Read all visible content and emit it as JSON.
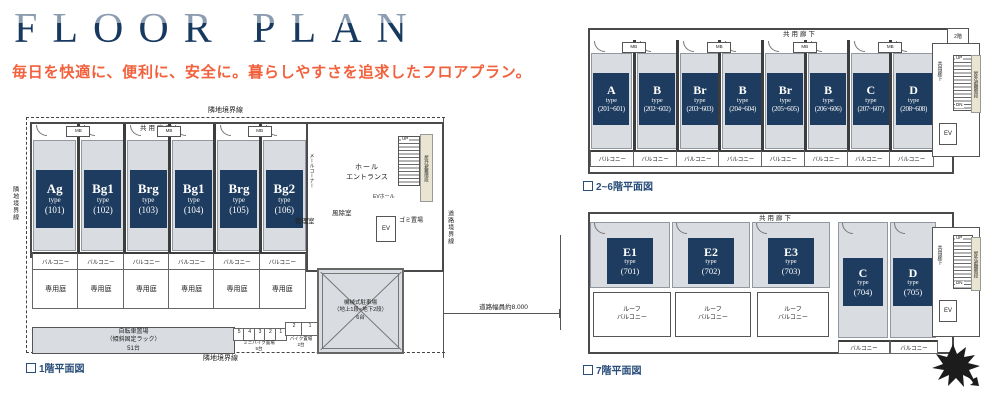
{
  "header": {
    "title": "FLOOR PLAN",
    "subtitle": "毎日を快適に、便利に、安全に。暮らしやすさを追求したフロアプラン。"
  },
  "labels": {
    "type_word": "type",
    "common_corridor": "共用廊下",
    "balcony": "バルコニー",
    "roof_line1": "ルーフ",
    "roof_line2": "バルコニー",
    "private_garden": "専用庭",
    "adjacent_boundary": "隣地境界線",
    "road_boundary": "道路境界線",
    "road_width": "道路幅員約8.000",
    "mb": "MB",
    "up": "UP",
    "dn": "DN",
    "ev": "EV",
    "ev_hall": "EVホール",
    "hall_line1": "ホール",
    "hall_line2": "エントランス",
    "windbreak_room": "風除室",
    "manager_room": "管理室",
    "garbage_area": "ゴミ置場",
    "mail_corner": "メールコーナー",
    "evac_stairs": "屋外避難階段",
    "note_2f": "2階",
    "bicycle_line1": "自転車置場",
    "bicycle_line2": "（傾斜固定ラック）",
    "bicycle_line3": "51台",
    "minibike_line1": "ミニバイク置場",
    "minibike_line2": "5台",
    "bike_line1": "バイク置場",
    "bike_line2": "2台",
    "mech_line1": "機械式駐車場",
    "mech_line2": "（地上1段×地下2段）",
    "mech_line3": "6台"
  },
  "plan1f": {
    "caption": "1階平面図",
    "units": [
      {
        "name": "Ag",
        "number": "(101)"
      },
      {
        "name": "Bg1",
        "number": "(102)"
      },
      {
        "name": "Brg",
        "number": "(103)"
      },
      {
        "name": "Bg1",
        "number": "(104)"
      },
      {
        "name": "Brg",
        "number": "(105)"
      },
      {
        "name": "Bg2",
        "number": "(106)"
      }
    ],
    "minibike_numbers": [
      "5",
      "4",
      "3",
      "2",
      "1"
    ],
    "bike_numbers": [
      "2",
      "1"
    ]
  },
  "plan26f": {
    "caption": "2~6階平面図",
    "units": [
      {
        "name": "A",
        "number": "(201~601)"
      },
      {
        "name": "B",
        "number": "(202~602)"
      },
      {
        "name": "Br",
        "number": "(203~603)"
      },
      {
        "name": "B",
        "number": "(204~604)"
      },
      {
        "name": "Br",
        "number": "(205~605)"
      },
      {
        "name": "B",
        "number": "(206~606)"
      },
      {
        "name": "C",
        "number": "(207~607)"
      },
      {
        "name": "D",
        "number": "(208~608)"
      }
    ]
  },
  "plan7f": {
    "caption": "7階平面図",
    "units": [
      {
        "name": "E1",
        "number": "(701)"
      },
      {
        "name": "E2",
        "number": "(702)"
      },
      {
        "name": "E3",
        "number": "(703)"
      },
      {
        "name": "C",
        "number": "(704)"
      },
      {
        "name": "D",
        "number": "(705)"
      }
    ]
  },
  "colors": {
    "unit_tag_navy": "#1d3c5f",
    "title_navy": "#17385f",
    "title_light": "#8c9cb1",
    "subtitle_orange": "#f2603c",
    "room_gray": "#d9dce1",
    "caption_blue": "#2a4e7a"
  }
}
